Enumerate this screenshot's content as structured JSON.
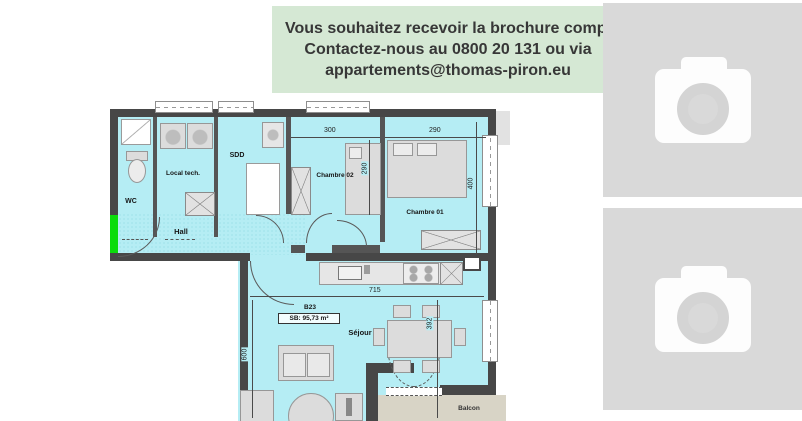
{
  "banner": {
    "line1": "Vous souhaitez recevoir la brochure compl",
    "line2": "Contactez-nous au 0800 20 131 ou via",
    "line3": "appartements@thomas-piron.eu",
    "bg_color": "#d5e8d4"
  },
  "floorplan": {
    "unit_code": "B23",
    "surface_label": "SB: 95,73 m²",
    "rooms": {
      "wc": "WC",
      "local_tech": "Local tech.",
      "sdd": "SDD",
      "hall": "Hall",
      "chambre02": "Chambre 02",
      "chambre01": "Chambre 01",
      "sejour": "Séjour",
      "balcon": "Balcon"
    },
    "dimensions": {
      "ch02_width": "300",
      "ch02_depth": "290",
      "ch01_width": "290",
      "ch01_depth": "400",
      "sejour_width": "715",
      "sejour_depth": "392",
      "sejour_left": "600"
    },
    "colors": {
      "floor": "#b5edf4",
      "wall": "#474747",
      "entry_marker": "#0bdc0b",
      "balcony_floor": "#d8d4c6"
    }
  },
  "gallery": {
    "bg": "#d9d9d9",
    "placeholders": [
      {
        "icon": "camera-icon"
      },
      {
        "icon": "camera-icon"
      }
    ]
  }
}
